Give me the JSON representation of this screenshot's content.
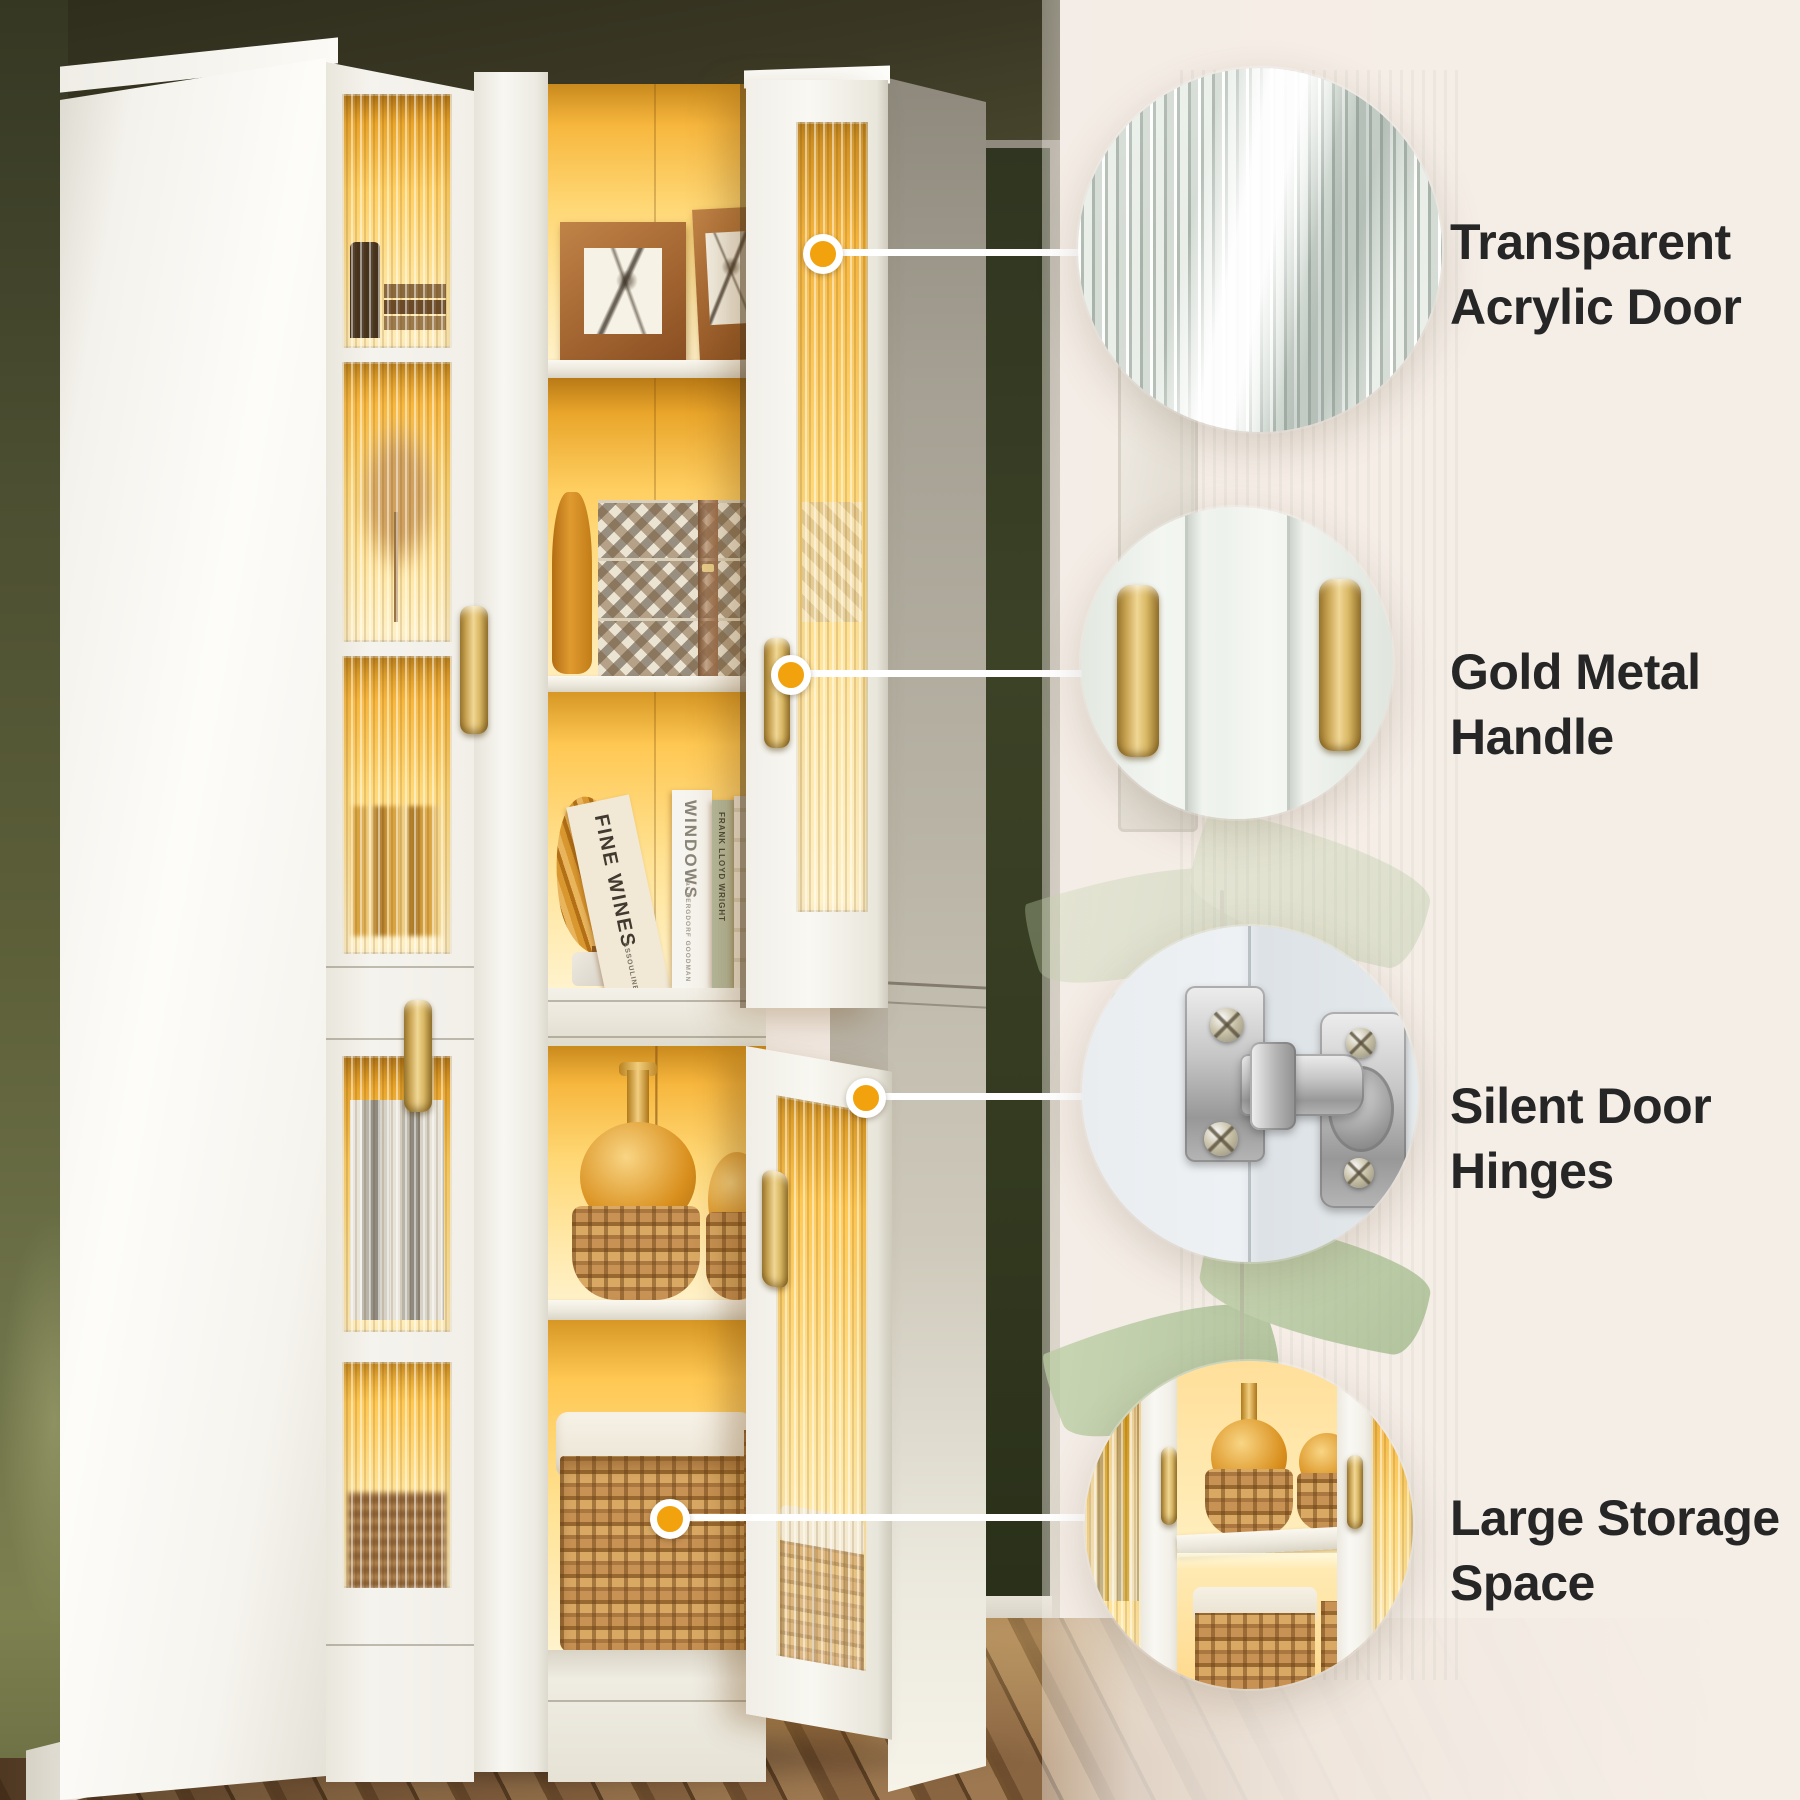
{
  "features": [
    {
      "id": "transparent-acrylic-door",
      "label": [
        "Transparent",
        "Acrylic Door"
      ],
      "photo": "fluted-acrylic-glass-texture",
      "marker_color": "#F2A20D"
    },
    {
      "id": "gold-metal-handle",
      "label": [
        "Gold Metal",
        "Handle"
      ],
      "photo": "gold-handles-on-white-doors",
      "marker_color": "#F2A20D"
    },
    {
      "id": "silent-door-hinges",
      "label": [
        "Silent Door",
        "Hinges"
      ],
      "photo": "stainless-concealed-hinge",
      "marker_color": "#F2A20D"
    },
    {
      "id": "large-storage-space",
      "label": [
        "Large Storage",
        "Space"
      ],
      "photo": "led-lit-storage-interior",
      "marker_color": "#F2A20D"
    }
  ],
  "decor": {
    "book_spines": {
      "fine_wines": "FINE WINES",
      "fine_wines_publisher": "ASSOULINE",
      "windows": "WINDOWS",
      "windows_sub": "at BERGDORF GOODMAN",
      "wright": "FRANK LLOYD WRIGHT"
    }
  },
  "colors": {
    "marker_orange": "#F2A20D",
    "connector_line": "#FFFFFF",
    "label_text": "#262626",
    "panel_beige": "#F4ECE5",
    "wall_olive": "#4C4F31",
    "accent_wall_green": "#343B20",
    "led_amber": "#FFD468",
    "handle_gold": "#D9B865",
    "cabinet_white": "#F5F3EE"
  }
}
